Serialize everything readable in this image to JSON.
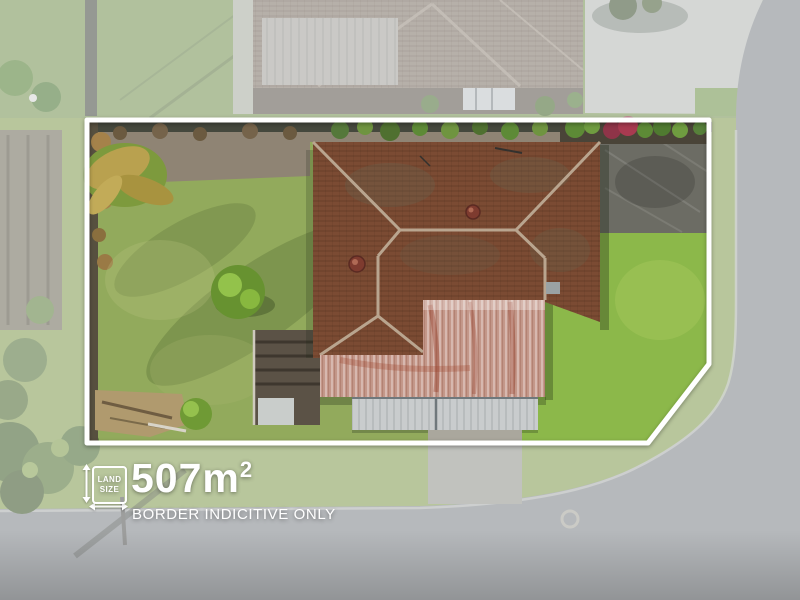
{
  "annotation": {
    "land_size_icon_label": {
      "line1": "LAND",
      "line2": "SIZE"
    },
    "area_value": "507m",
    "area_exponent": "2",
    "disclaimer": "BORDER INDICITIVE ONLY"
  },
  "boundary": {
    "color": "#ffffff",
    "shape": "rectangle with chamfered bottom-right corner"
  },
  "scene": {
    "colors": {
      "lawn_left": "#92aa5c",
      "lawn_right": "#8cb84a",
      "top_grass": "#86a15e",
      "roof_tiles": "#7b4b33",
      "roof_rusty_metal": "#c4988a",
      "roof_light_metal": "#c9cccd",
      "neighbor_roof": "#8f8274",
      "road": "#8f9296",
      "driveway_concrete": "#c6c8c4",
      "stamped_concrete": "#6c6c64",
      "dirt": "#8f8474",
      "wash_overlay": "#e6e9ec"
    }
  }
}
